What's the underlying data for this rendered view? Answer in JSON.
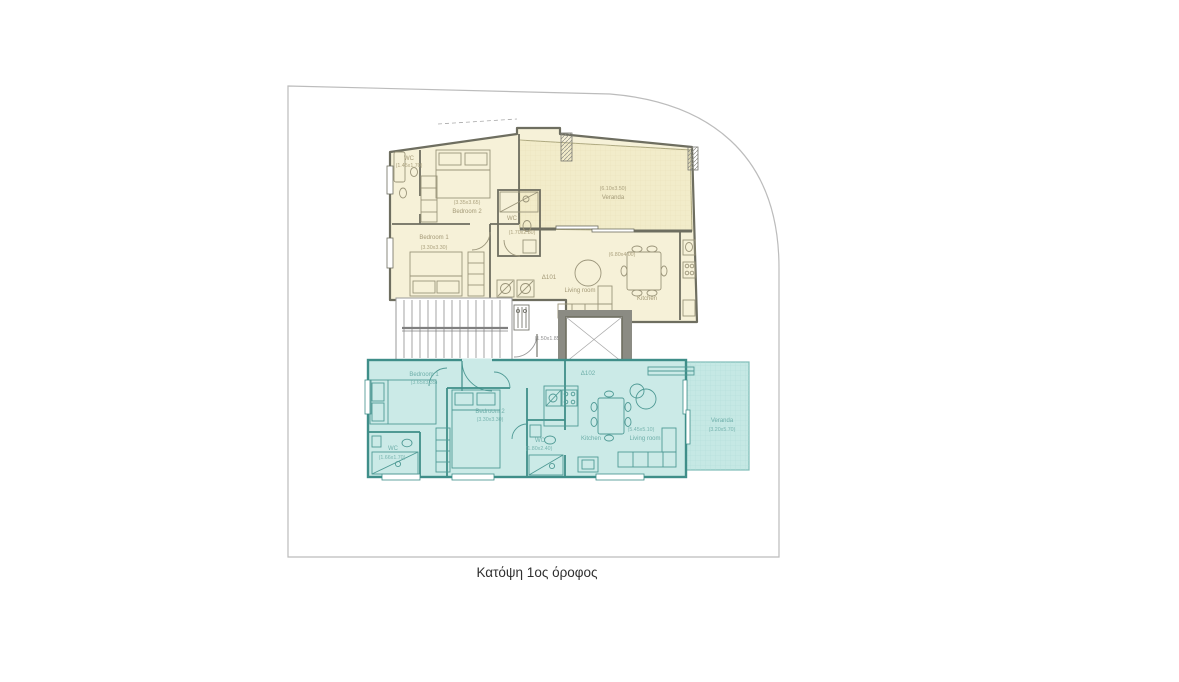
{
  "caption": "Κατόψη 1ος όροφος",
  "colors": {
    "apartment_a101_fill": "#f6f1d8",
    "apartment_a101_veranda_fill": "#f2ecca",
    "apartment_a101_wall": "#6e6e60",
    "apartment_a102_fill": "#cbeae7",
    "apartment_a102_veranda_fill": "#c5e8e4",
    "apartment_a102_wall": "#3f8e89",
    "site_boundary": "#bcbcbc",
    "core_gray": "#8b8b83"
  },
  "floor_plan": {
    "apartment_a101": {
      "unit_id": "Δ101",
      "rooms": {
        "wc_top": {
          "name": "WC",
          "dims": "(1.45x1.70)"
        },
        "bedroom2": {
          "name": "Bedroom 2",
          "dims": "(3.35x3.65)"
        },
        "bedroom1": {
          "name": "Bedroom 1",
          "dims": "(3.30x3.30)"
        },
        "wc_mid": {
          "name": "WC",
          "dims": "(1.70x2.80)"
        },
        "veranda": {
          "name": "Veranda",
          "dims": "(6.10x3.50)"
        },
        "living_room": {
          "name": "Living room"
        },
        "kitchen": {
          "name": "Kitchen"
        },
        "living_kitchen_dims": "(6.80x4.00)"
      }
    },
    "core": {
      "lobby_dims": "(1.50x1.85)"
    },
    "apartment_a102": {
      "unit_id": "Δ102",
      "rooms": {
        "bedroom1": {
          "name": "Bedroom 1",
          "dims": "(3.65x3.35)"
        },
        "bedroom2": {
          "name": "Bedroom 2",
          "dims": "(3.30x3.30)"
        },
        "wc_left": {
          "name": "WC",
          "dims": "(1.66x1.70)"
        },
        "wc_mid": {
          "name": "WC",
          "dims": "(1.80x2.40)"
        },
        "kitchen": {
          "name": "Kitchen"
        },
        "living_room": {
          "name": "Living room",
          "dims": "(5.45x5.10)"
        },
        "veranda": {
          "name": "Veranda",
          "dims": "(3.20x5.70)"
        }
      }
    }
  }
}
